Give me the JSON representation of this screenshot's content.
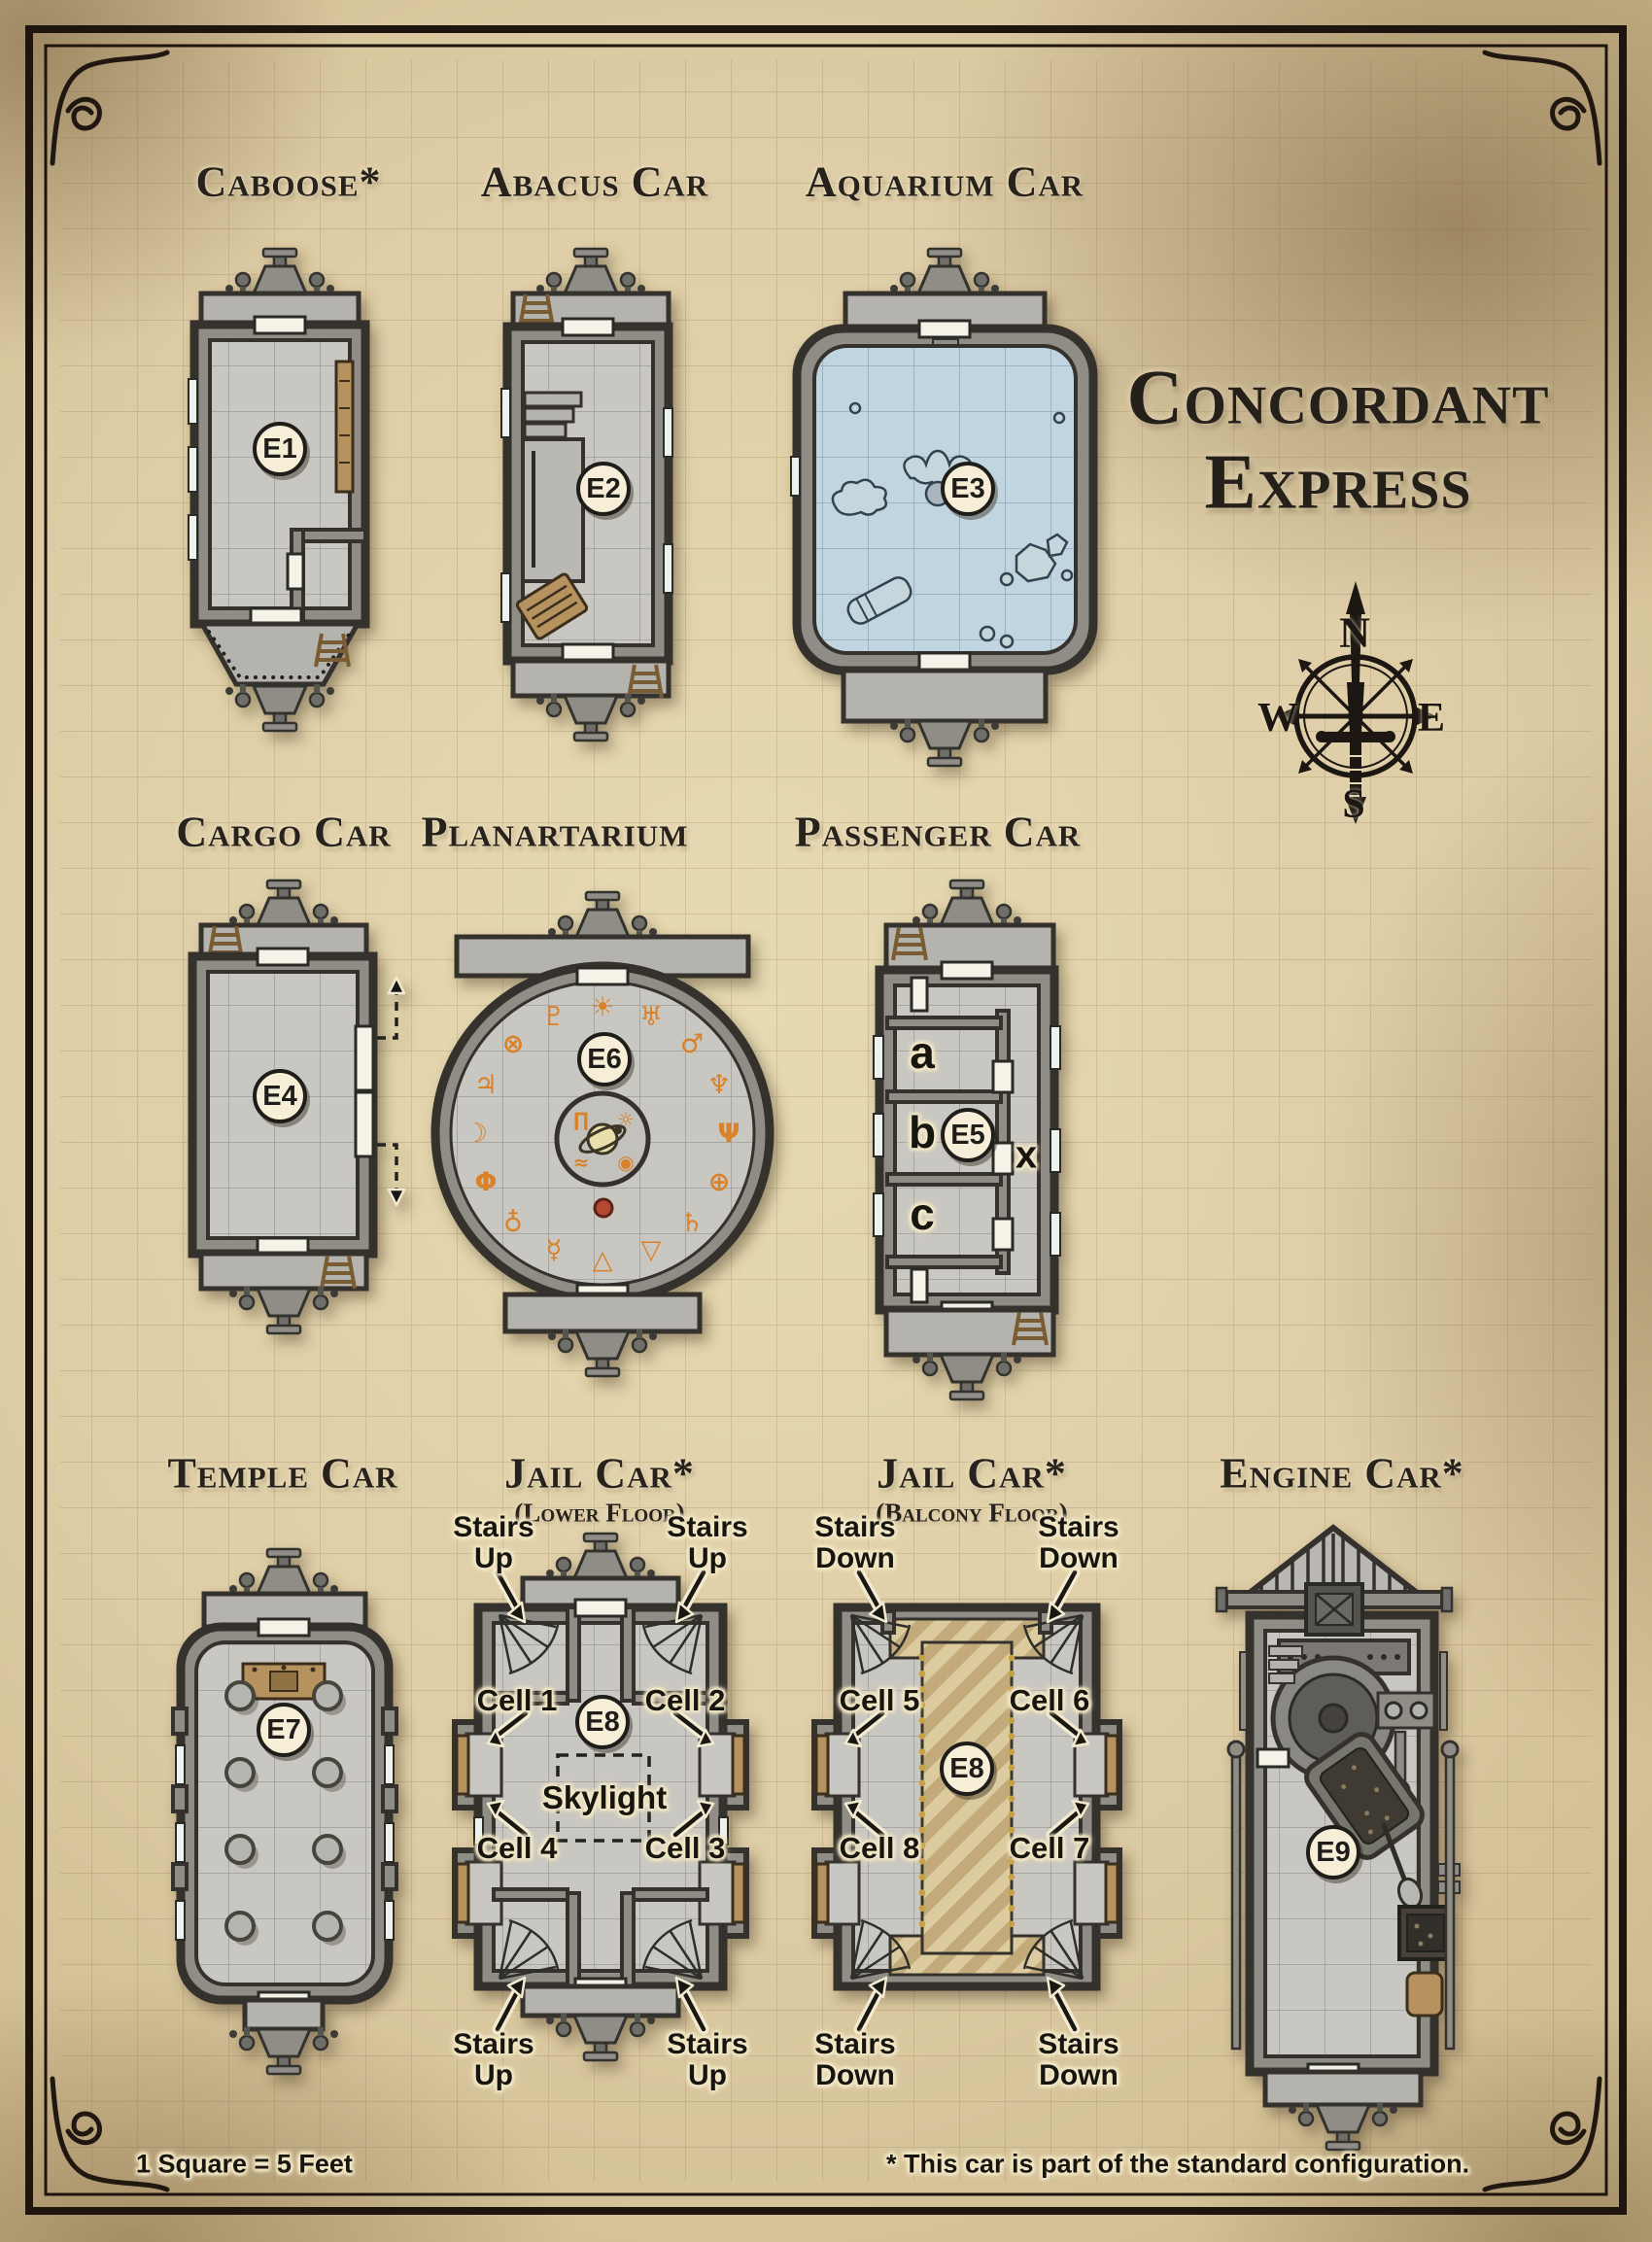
{
  "page": {
    "title_lines": [
      "Concordant",
      "Express"
    ],
    "compass": {
      "north": "N",
      "east": "E",
      "south": "S",
      "west": "W"
    },
    "labels": {
      "stairs": "Stairs",
      "up": "Up",
      "down": "Down"
    },
    "footer": {
      "scale": "1 Square = 5 Feet",
      "note": "* This car is part of the standard configuration."
    },
    "cars": [
      {
        "name": "caboose",
        "title": "Caboose*",
        "badge": "E1"
      },
      {
        "name": "abacus-car",
        "title": "Abacus Car",
        "badge": "E2"
      },
      {
        "name": "aquarium-car",
        "title": "Aquarium Car",
        "badge": "E3"
      },
      {
        "name": "cargo-car",
        "title": "Cargo Car",
        "badge": "E4"
      },
      {
        "name": "planartarium",
        "title": "Planartarium",
        "badge": "E6",
        "ring_symbols": [
          "☀",
          "♅",
          "♂",
          "♆",
          "Ψ",
          "⊕",
          "♄",
          "▽",
          "△",
          "☿",
          "♁",
          "Φ",
          "☽",
          "♃",
          "⊗",
          "♇"
        ],
        "inner_symbols": [
          "∏",
          "☼",
          "≈",
          "◉"
        ]
      },
      {
        "name": "passenger-car",
        "title": "Passenger Car",
        "badge": "E5",
        "rooms": [
          "a",
          "b",
          "c"
        ],
        "door_mark": "x"
      },
      {
        "name": "temple-car",
        "title": "Temple Car",
        "badge": "E7"
      },
      {
        "name": "jail-car-lower",
        "title": "Jail Car*",
        "subtitle": "(Lower Floor)",
        "badge": "E8",
        "cells": [
          "Cell 1",
          "Cell 2",
          "Cell 3",
          "Cell 4"
        ],
        "skylight": "Skylight"
      },
      {
        "name": "jail-car-balcony",
        "title": "Jail Car*",
        "subtitle": "(Balcony Floor)",
        "badge": "E8",
        "cells": [
          "Cell 5",
          "Cell 6",
          "Cell 7",
          "Cell 8"
        ]
      },
      {
        "name": "engine-car",
        "title": "Engine Car*",
        "badge": "E9"
      }
    ]
  }
}
